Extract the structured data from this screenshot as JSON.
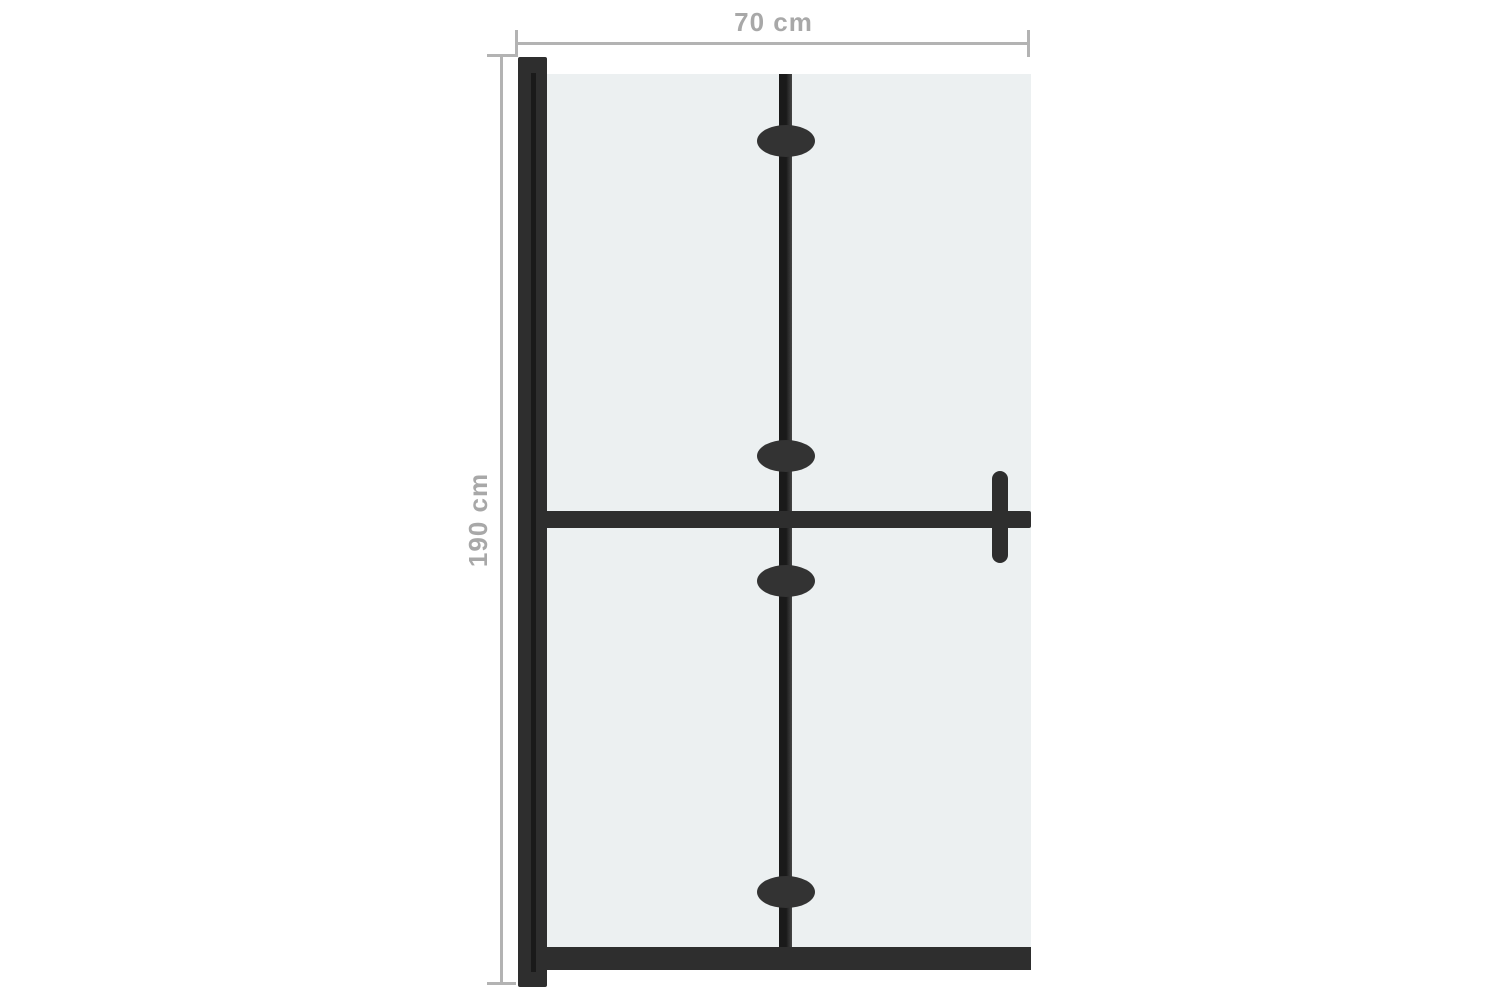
{
  "diagram": {
    "dimensions": {
      "width": {
        "label": "70 cm"
      },
      "height": {
        "label": "190 cm"
      }
    },
    "colors": {
      "background": "#ffffff",
      "glass": "#ecf0f1",
      "frame": "#2e2e2e",
      "frame_groove": "#1a1a1a",
      "dim_line": "#b3b3b3",
      "dim_text": "#a8a8a8"
    }
  }
}
